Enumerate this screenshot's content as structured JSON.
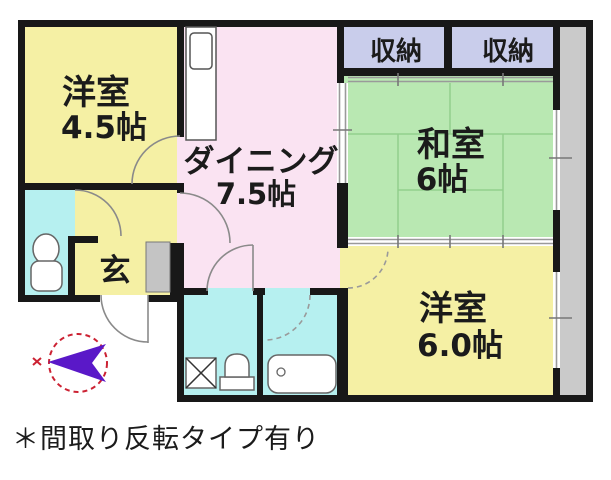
{
  "floorplan": {
    "rooms": {
      "western_room_small": {
        "name": "洋室",
        "size": "4.5帖"
      },
      "dining": {
        "name": "ダイニング",
        "size": "7.5帖"
      },
      "japanese_room": {
        "name": "和室",
        "size": "6帖"
      },
      "western_room_large": {
        "name": "洋室",
        "size": "6.0帖"
      },
      "storage_left": {
        "label": "収納"
      },
      "storage_right": {
        "label": "収納"
      },
      "entrance": {
        "label": "玄"
      }
    },
    "note": "＊間取り反転タイプ有り",
    "colors": {
      "room_yellow": "#f5f0a4",
      "dining_pink": "#fae3f2",
      "tatami_green": "#b9e8b2",
      "water_cyan": "#b6f0f0",
      "storage_lavender": "#c9cdeb",
      "balcony_gray": "#cacaca",
      "compass_red": "#cc2233",
      "compass_arrow_purple": "#5a18c8",
      "wall_black": "#181818"
    }
  }
}
